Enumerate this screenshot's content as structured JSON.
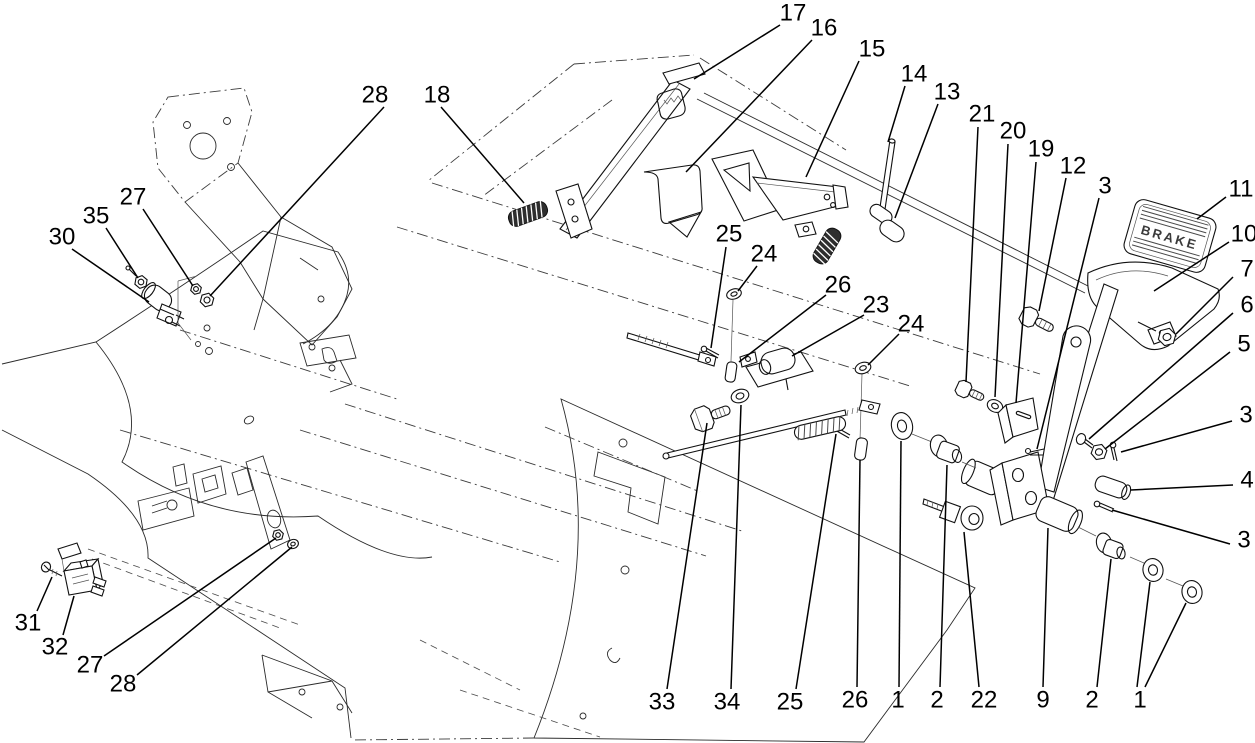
{
  "diagram": {
    "type": "exploded-parts-diagram",
    "subject": "brake-pedal-assembly",
    "canvas": {
      "width": 1255,
      "height": 743,
      "background": "#ffffff",
      "line_color": "#1a1a1a"
    },
    "pedal_pad_text": "BRAKE",
    "callouts": [
      {
        "id": "17",
        "label": "17",
        "x": 793,
        "y": 13,
        "leaders": [
          [
            780,
            25,
            694,
            79
          ]
        ]
      },
      {
        "id": "16",
        "label": "16",
        "x": 824,
        "y": 28,
        "leaders": [
          [
            812,
            40,
            686,
            172
          ]
        ]
      },
      {
        "id": "15",
        "label": "15",
        "x": 872,
        "y": 49,
        "leaders": [
          [
            859,
            61,
            806,
            177
          ]
        ]
      },
      {
        "id": "14",
        "label": "14",
        "x": 914,
        "y": 74,
        "leaders": [
          [
            905,
            86,
            888,
            142
          ]
        ]
      },
      {
        "id": "13",
        "label": "13",
        "x": 947,
        "y": 92,
        "leaders": [
          [
            938,
            104,
            895,
            218
          ]
        ]
      },
      {
        "id": "21",
        "label": "21",
        "x": 982,
        "y": 114,
        "leaders": [
          [
            978,
            127,
            966,
            382
          ]
        ]
      },
      {
        "id": "20",
        "label": "20",
        "x": 1013,
        "y": 131,
        "leaders": [
          [
            1008,
            144,
            995,
            397
          ]
        ]
      },
      {
        "id": "19",
        "label": "19",
        "x": 1041,
        "y": 149,
        "leaders": [
          [
            1036,
            162,
            1016,
            403
          ]
        ]
      },
      {
        "id": "12",
        "label": "12",
        "x": 1073,
        "y": 166,
        "leaders": [
          [
            1066,
            178,
            1039,
            311
          ]
        ]
      },
      {
        "id": "3a",
        "label": "3",
        "x": 1105,
        "y": 186,
        "leaders": [
          [
            1099,
            198,
            1037,
            449
          ]
        ]
      },
      {
        "id": "11",
        "label": "11",
        "x": 1241,
        "y": 189,
        "leaders": [
          [
            1226,
            197,
            1197,
            219
          ]
        ]
      },
      {
        "id": "10",
        "label": "10",
        "x": 1244,
        "y": 234,
        "leaders": [
          [
            1229,
            242,
            1154,
            291
          ]
        ]
      },
      {
        "id": "7",
        "label": "7",
        "x": 1247,
        "y": 269,
        "leaders": [
          [
            1233,
            277,
            1176,
            334
          ]
        ]
      },
      {
        "id": "6",
        "label": "6",
        "x": 1247,
        "y": 305,
        "leaders": [
          [
            1233,
            313,
            1089,
            439
          ]
        ]
      },
      {
        "id": "5",
        "label": "5",
        "x": 1244,
        "y": 344,
        "leaders": [
          [
            1230,
            352,
            1105,
            449
          ]
        ]
      },
      {
        "id": "3b",
        "label": "3",
        "x": 1246,
        "y": 415,
        "leaders": [
          [
            1232,
            421,
            1121,
            452
          ]
        ]
      },
      {
        "id": "4",
        "label": "4",
        "x": 1247,
        "y": 480,
        "leaders": [
          [
            1233,
            485,
            1131,
            490
          ]
        ]
      },
      {
        "id": "3c",
        "label": "3",
        "x": 1244,
        "y": 540,
        "leaders": [
          [
            1230,
            544,
            1112,
            510
          ]
        ]
      },
      {
        "id": "28a",
        "label": "28",
        "x": 375,
        "y": 95,
        "leaders": [
          [
            384,
            107,
            210,
            296
          ]
        ]
      },
      {
        "id": "18",
        "label": "18",
        "x": 437,
        "y": 95,
        "leaders": [
          [
            441,
            107,
            524,
            203
          ]
        ]
      },
      {
        "id": "27a",
        "label": "27",
        "x": 133,
        "y": 197,
        "leaders": [
          [
            143,
            209,
            193,
            286
          ]
        ]
      },
      {
        "id": "35",
        "label": "35",
        "x": 96,
        "y": 216,
        "leaders": [
          [
            106,
            228,
            138,
            278
          ]
        ]
      },
      {
        "id": "30",
        "label": "30",
        "x": 62,
        "y": 237,
        "leaders": [
          [
            72,
            249,
            149,
            302
          ]
        ]
      },
      {
        "id": "25a",
        "label": "25",
        "x": 729,
        "y": 234,
        "leaders": [
          [
            726,
            247,
            711,
            348
          ]
        ]
      },
      {
        "id": "24a",
        "label": "24",
        "x": 764,
        "y": 254,
        "leaders": [
          [
            757,
            266,
            738,
            291
          ]
        ]
      },
      {
        "id": "26a",
        "label": "26",
        "x": 838,
        "y": 285,
        "leaders": [
          [
            826,
            295,
            739,
            362
          ]
        ]
      },
      {
        "id": "23",
        "label": "23",
        "x": 876,
        "y": 305,
        "leaders": [
          [
            864,
            315,
            792,
            356
          ]
        ]
      },
      {
        "id": "24b",
        "label": "24",
        "x": 911,
        "y": 324,
        "leaders": [
          [
            899,
            334,
            868,
            365
          ]
        ]
      },
      {
        "id": "31",
        "label": "31",
        "x": 28,
        "y": 623,
        "leaders": [
          [
            37,
            611,
            52,
            577
          ]
        ]
      },
      {
        "id": "32",
        "label": "32",
        "x": 55,
        "y": 647,
        "leaders": [
          [
            63,
            635,
            74,
            596
          ]
        ]
      },
      {
        "id": "27b",
        "label": "27",
        "x": 90,
        "y": 665,
        "leaders": [
          [
            104,
            656,
            276,
            538
          ]
        ]
      },
      {
        "id": "28b",
        "label": "28",
        "x": 123,
        "y": 684,
        "leaders": [
          [
            137,
            675,
            292,
            547
          ]
        ]
      },
      {
        "id": "33",
        "label": "33",
        "x": 662,
        "y": 702,
        "leaders": [
          [
            667,
            689,
            707,
            423
          ]
        ]
      },
      {
        "id": "34",
        "label": "34",
        "x": 727,
        "y": 702,
        "leaders": [
          [
            731,
            689,
            741,
            405
          ]
        ]
      },
      {
        "id": "25b",
        "label": "25",
        "x": 790,
        "y": 702,
        "leaders": [
          [
            796,
            689,
            836,
            434
          ]
        ]
      },
      {
        "id": "26b",
        "label": "26",
        "x": 855,
        "y": 700,
        "leaders": [
          [
            857,
            687,
            860,
            460
          ]
        ]
      },
      {
        "id": "1a",
        "label": "1",
        "x": 898,
        "y": 700,
        "leaders": [
          [
            899,
            687,
            901,
            441
          ]
        ]
      },
      {
        "id": "2a",
        "label": "2",
        "x": 937,
        "y": 700,
        "leaders": [
          [
            940,
            687,
            947,
            465
          ]
        ]
      },
      {
        "id": "22",
        "label": "22",
        "x": 984,
        "y": 700,
        "leaders": [
          [
            979,
            687,
            964,
            532
          ]
        ]
      },
      {
        "id": "9",
        "label": "9",
        "x": 1043,
        "y": 700,
        "leaders": [
          [
            1043,
            687,
            1048,
            528
          ]
        ]
      },
      {
        "id": "2b",
        "label": "2",
        "x": 1092,
        "y": 700,
        "leaders": [
          [
            1097,
            687,
            1111,
            559
          ]
        ]
      },
      {
        "id": "1b",
        "label": "1",
        "x": 1140,
        "y": 700,
        "leaders": [
          [
            1137,
            687,
            1150,
            582
          ],
          [
            1145,
            687,
            1186,
            603
          ]
        ]
      }
    ]
  }
}
